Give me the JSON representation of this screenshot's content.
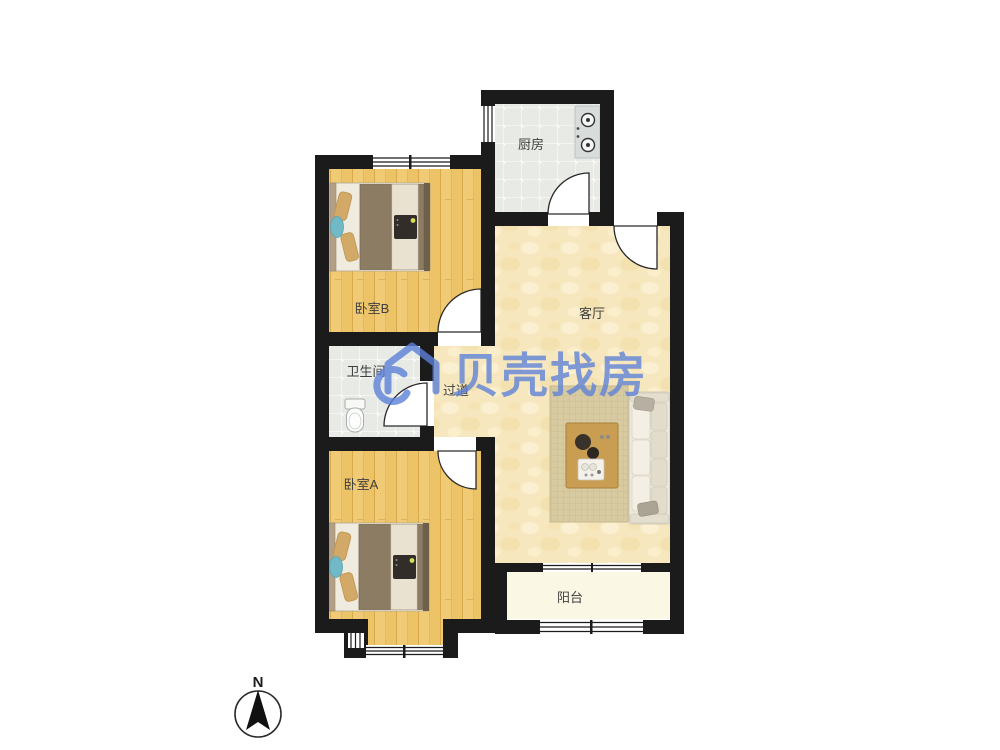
{
  "page": {
    "background": "#ffffff",
    "type": "apartment-floorplan"
  },
  "rooms": {
    "kitchen": "厨房",
    "living": "客厅",
    "bedroom_b": "卧室B",
    "bathroom": "卫生间",
    "hallway": "过道",
    "bedroom_a": "卧室A",
    "balcony": "阳台"
  },
  "watermark": {
    "brand": "贝壳找房",
    "color": "#5C81D8"
  },
  "compass": {
    "north_label": "N"
  },
  "colors": {
    "wall": "#1B1B1B",
    "wood_floor": "#ECC366",
    "living_floor": "#F7E7BE",
    "tile_floor": "#E8EAE5",
    "balcony_floor": "#FAF7E5",
    "rug": "#D8CBA2",
    "sofa": "#EDE8DB",
    "duvet": "#8C7C64",
    "watermark_blue": "#5C81D8"
  }
}
